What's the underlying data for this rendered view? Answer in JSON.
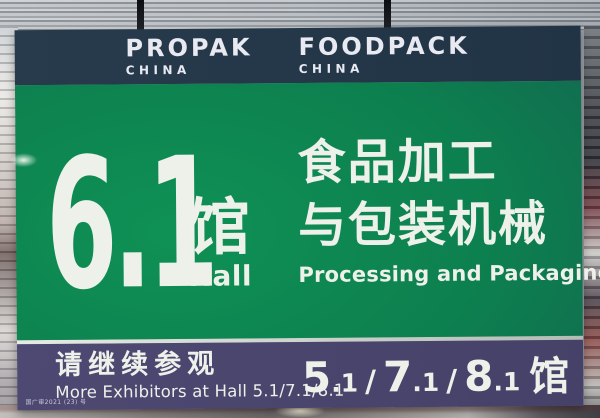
{
  "sign": {
    "brands": [
      {
        "name": "PROPAK",
        "region": "CHINA"
      },
      {
        "name": "FOODPACK",
        "region": "CHINA"
      }
    ],
    "hall": {
      "number": "6.1",
      "label_cjk": "馆",
      "label_en": "Hall"
    },
    "category": {
      "cjk_line1": "食品加工",
      "cjk_line2": "与包装机械",
      "en": "Processing and Packaging"
    },
    "footer": {
      "notice_cjk": "请继续参观",
      "notice_en": "More Exhibitors at Hall 5.1/7.1/8.1",
      "halls": [
        {
          "major": "5",
          "minor": ".1"
        },
        {
          "major": "7",
          "minor": ".1"
        },
        {
          "major": "8",
          "minor": ".1"
        }
      ],
      "halls_separator": "/",
      "halls_suffix_cjk": "馆",
      "approval_number": "国广审2021 (23) 号"
    }
  },
  "colors": {
    "header_navy": "#243849",
    "sign_green": "#0e8150",
    "footer_purple": "#4b4770",
    "divider_light": "#ccd3cc",
    "text_offwhite": "#eef0ea"
  }
}
